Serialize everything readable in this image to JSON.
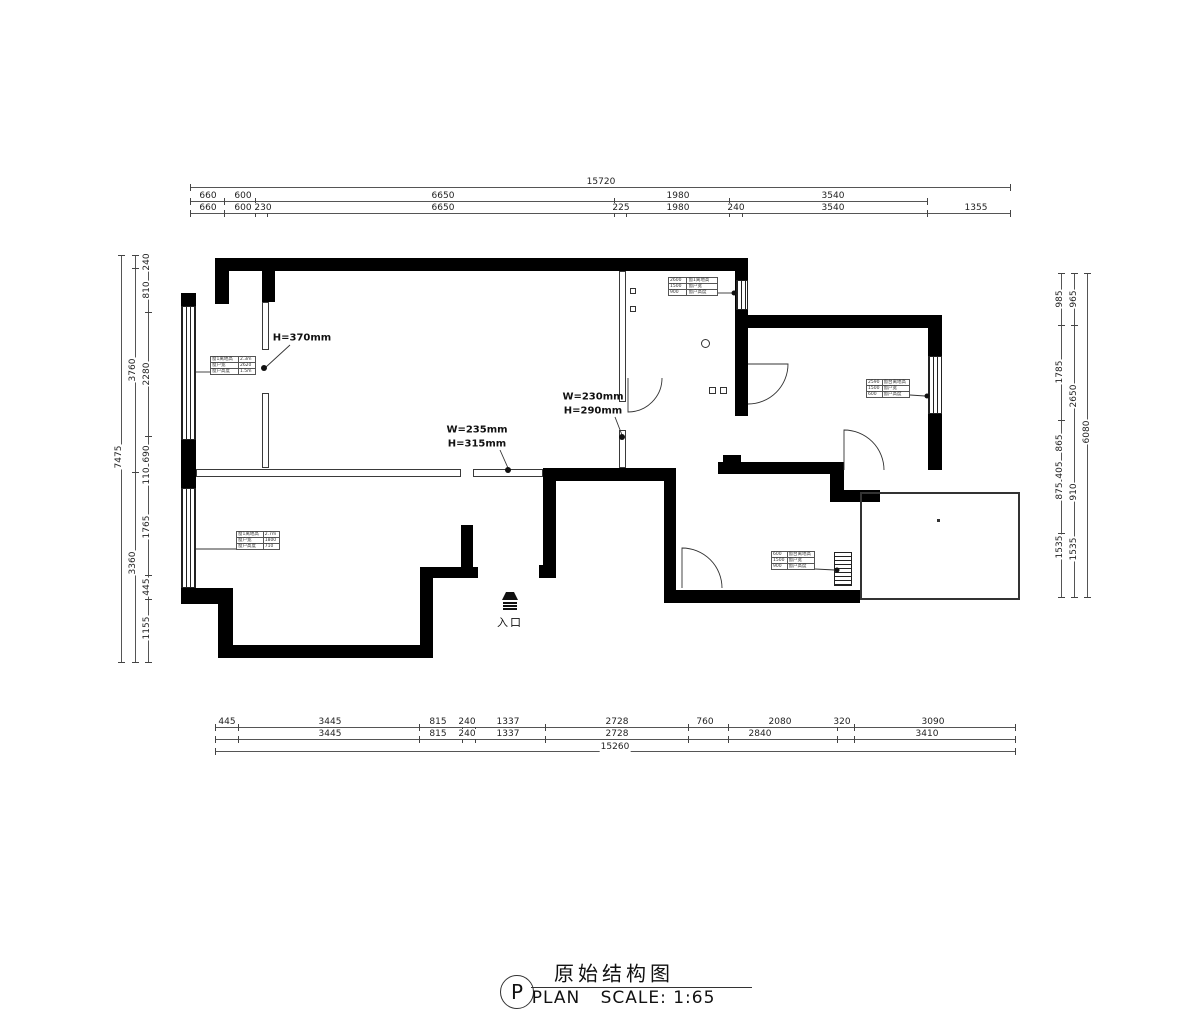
{
  "title_block": {
    "letter": "P",
    "plan_label": "PLAN",
    "title": "原始结构图",
    "scale_label": "SCALE: 1:65"
  },
  "entry": {
    "label": "入口"
  },
  "annotations": {
    "beam_height": "H=370mm",
    "opening1_w": "W=235mm",
    "opening1_h": "H=315mm",
    "opening2_w": "W=230mm",
    "opening2_h": "H=290mm"
  },
  "dims": {
    "top": {
      "overall": "15720",
      "row1": [
        "660",
        "600",
        "6650",
        "1980",
        "3540"
      ],
      "row2": [
        "660",
        "600",
        "230",
        "6650",
        "225",
        "1980",
        "240",
        "3540",
        "1355"
      ]
    },
    "bottom": {
      "overall": "15260",
      "row1": [
        "445",
        "3445",
        "815",
        "240",
        "1337",
        "2728",
        "760",
        "2080",
        "320",
        "3090"
      ],
      "row2": [
        "3445",
        "815",
        "240",
        "1337",
        "2728",
        "2840",
        "3410"
      ]
    },
    "left": {
      "overall": "7475",
      "mid": [
        "3760",
        "3360"
      ],
      "inner": [
        "240",
        "810",
        "2280",
        "690",
        "110",
        "1765",
        "445",
        "1155"
      ]
    },
    "right": {
      "overall": "6080",
      "mid": [
        "965",
        "2650",
        "910",
        "1535"
      ],
      "inner": [
        "985",
        "1785",
        "865",
        "405",
        "875",
        "1535"
      ]
    }
  },
  "tables": {
    "t1": {
      "rows": [
        [
          "窗1离地高",
          "2.3m"
        ],
        [
          "窗户宽",
          "2620"
        ],
        [
          "窗户高度",
          "1.5m"
        ]
      ]
    },
    "t2": {
      "rows": [
        [
          "2600",
          "窗1离地高"
        ],
        [
          "1500",
          "窗户宽"
        ],
        [
          "900",
          "窗户高度"
        ]
      ]
    },
    "t3": {
      "rows": [
        [
          "2590",
          "窗台离地高"
        ],
        [
          "1500",
          "窗户宽"
        ],
        [
          "600",
          "窗户高度"
        ]
      ]
    },
    "t4": {
      "rows": [
        [
          "窗1离地高",
          "2.7m"
        ],
        [
          "窗户宽",
          "1800"
        ],
        [
          "窗户高度",
          "710"
        ]
      ]
    },
    "t5": {
      "rows": [
        [
          "600",
          "窗台离地高"
        ],
        [
          "1500",
          "窗户宽"
        ],
        [
          "900",
          "窗户高度"
        ]
      ]
    }
  }
}
